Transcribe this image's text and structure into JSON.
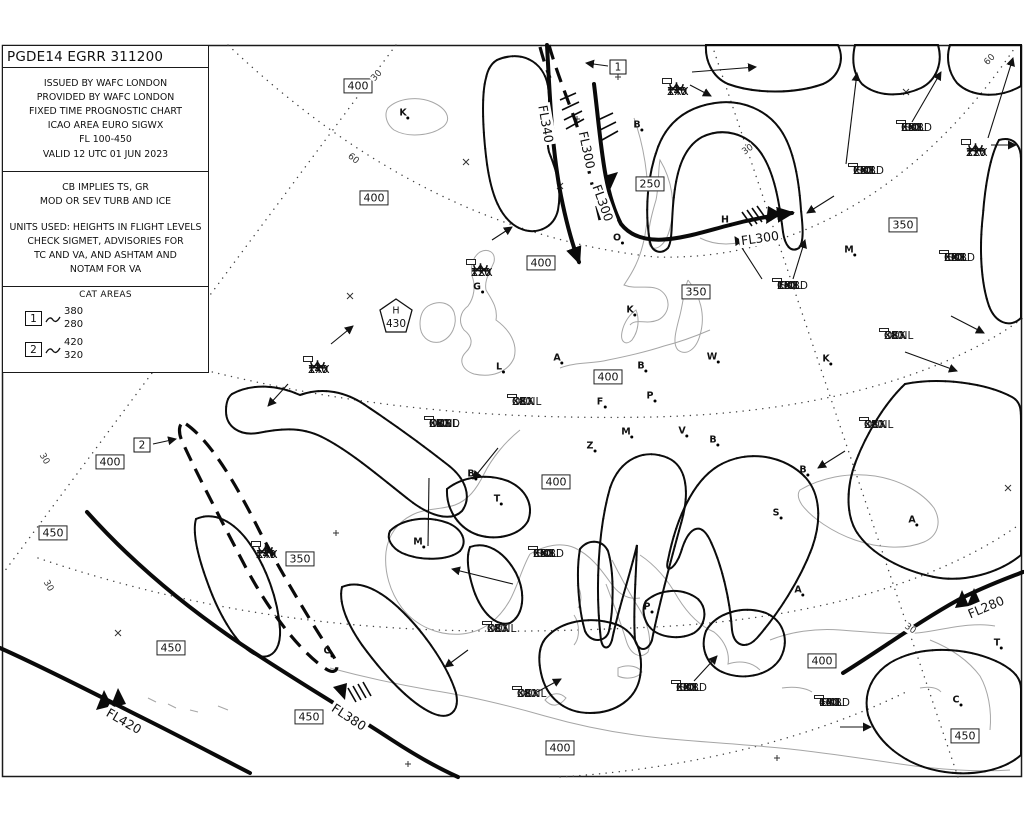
{
  "header": {
    "title": "PGDE14 EGRR 311200",
    "info_lines": [
      "ISSUED BY WAFC LONDON",
      "PROVIDED BY WAFC LONDON",
      "FIXED TIME PROGNOSTIC CHART",
      "ICAO AREA EURO SIGWX",
      "FL 100-450",
      "VALID 12 UTC 01 JUN 2023"
    ],
    "cb_note": [
      "CB IMPLIES TS, GR",
      "MOD OR SEV TURB AND ICE"
    ],
    "units_note": [
      "UNITS USED: HEIGHTS IN FLIGHT LEVELS",
      "CHECK SIGMET, ADVISORIES FOR",
      "TC AND VA, AND ASHTAM AND",
      "NOTAM FOR VA"
    ],
    "cat_areas": {
      "label": "CAT AREAS",
      "items": [
        {
          "id": "1",
          "top": "380",
          "base": "280"
        },
        {
          "id": "2",
          "top": "420",
          "base": "320"
        }
      ]
    }
  },
  "map": {
    "trop_high": {
      "label": "H",
      "value": "430"
    },
    "fl_boxes": [
      {
        "v": "400",
        "x": 358,
        "y": 86
      },
      {
        "v": "250",
        "x": 650,
        "y": 184
      },
      {
        "v": "400",
        "x": 374,
        "y": 198
      },
      {
        "v": "350",
        "x": 903,
        "y": 225
      },
      {
        "v": "400",
        "x": 541,
        "y": 263
      },
      {
        "v": "350",
        "x": 696,
        "y": 292
      },
      {
        "v": "400",
        "x": 608,
        "y": 377
      },
      {
        "v": "400",
        "x": 110,
        "y": 462
      },
      {
        "v": "450",
        "x": 53,
        "y": 533
      },
      {
        "v": "400",
        "x": 556,
        "y": 482
      },
      {
        "v": "350",
        "x": 300,
        "y": 559
      },
      {
        "v": "450",
        "x": 171,
        "y": 648
      },
      {
        "v": "400",
        "x": 822,
        "y": 661
      },
      {
        "v": "450",
        "x": 309,
        "y": 717
      },
      {
        "v": "400",
        "x": 560,
        "y": 748
      },
      {
        "v": "450",
        "x": 965,
        "y": 736
      }
    ],
    "cb_boxes": [
      {
        "lines": [
          "ISOL",
          "EMBD",
          "CB",
          "250",
          "XXX"
        ],
        "x": 853,
        "y": 163
      },
      {
        "lines": [
          "ISOL",
          "EMBD",
          "CB",
          "350",
          "XXX"
        ],
        "x": 901,
        "y": 120
      },
      {
        "lines": [
          "ISOL",
          "EMBD",
          "CB",
          "180",
          "XXX"
        ],
        "x": 777,
        "y": 278
      },
      {
        "lines": [
          "ISOL",
          "EMBD",
          "CB",
          "320",
          "XXX"
        ],
        "x": 944,
        "y": 250
      },
      {
        "lines": [
          "OCNL",
          "CB",
          "380",
          "XXX"
        ],
        "x": 884,
        "y": 328
      },
      {
        "lines": [
          "OCNL",
          "CB",
          "380",
          "XXX"
        ],
        "x": 864,
        "y": 417
      },
      {
        "lines": [
          "OCNL",
          "EMBD",
          "CB",
          "380",
          "XXX"
        ],
        "x": 429,
        "y": 416
      },
      {
        "lines": [
          "OCNL",
          "CB",
          "380",
          "XXX"
        ],
        "x": 512,
        "y": 394
      },
      {
        "lines": [
          "ISOL",
          "EMBD",
          "CB",
          "350",
          "XXX"
        ],
        "x": 533,
        "y": 546
      },
      {
        "lines": [
          "OCNL",
          "CB",
          "380",
          "XXX"
        ],
        "x": 487,
        "y": 621
      },
      {
        "lines": [
          "OCNL",
          "CB",
          "380",
          "XXX"
        ],
        "x": 517,
        "y": 686
      },
      {
        "lines": [
          "ISOL",
          "EMBD",
          "CB",
          "320",
          "XXX"
        ],
        "x": 676,
        "y": 680
      },
      {
        "lines": [
          "ISOL",
          "EMBD",
          "CB",
          "400",
          "140"
        ],
        "x": 819,
        "y": 695
      }
    ],
    "turb_ice_boxes": [
      {
        "turb": [
          "140",
          "XXX"
        ],
        "ice": [
          "140",
          "XXX"
        ],
        "x": 667,
        "y": 81
      },
      {
        "turb": [
          "120",
          "XXX"
        ],
        "ice": [
          "120",
          "XXX"
        ],
        "x": 471,
        "y": 262
      },
      {
        "turb": [
          "140",
          "XXX"
        ],
        "ice": [
          "140",
          "XXX"
        ],
        "x": 308,
        "y": 359
      },
      {
        "turb": [
          "220",
          "XXX"
        ],
        "ice": [
          "220",
          "110"
        ],
        "x": 966,
        "y": 142
      },
      {
        "turb": [
          "140",
          "XXX"
        ],
        "ice": [
          "140",
          "XXX"
        ],
        "x": 256,
        "y": 544
      }
    ],
    "cat_markers": [
      {
        "id": "1",
        "x": 618,
        "y": 67
      },
      {
        "id": "2",
        "x": 142,
        "y": 445
      }
    ],
    "jet_labels": [
      {
        "t": "FL340",
        "x": 546,
        "y": 124,
        "rot": 80
      },
      {
        "t": "FL300",
        "x": 587,
        "y": 150,
        "rot": 78
      },
      {
        "t": "FL300",
        "x": 603,
        "y": 203,
        "rot": 70
      },
      {
        "t": "FL300",
        "x": 760,
        "y": 238,
        "rot": -8
      },
      {
        "t": "FL420",
        "x": 124,
        "y": 721,
        "rot": 30
      },
      {
        "t": "FL380",
        "x": 349,
        "y": 717,
        "rot": 33
      },
      {
        "t": "FL280",
        "x": 986,
        "y": 607,
        "rot": -23
      }
    ],
    "grat_labels": [
      {
        "t": "60",
        "x": 353,
        "y": 159,
        "rot": 40
      },
      {
        "t": "60",
        "x": 990,
        "y": 60,
        "rot": -45
      },
      {
        "t": "30",
        "x": 377,
        "y": 76,
        "rot": -48
      },
      {
        "t": "30",
        "x": 44,
        "y": 459,
        "rot": 60
      },
      {
        "t": "30",
        "x": 48,
        "y": 586,
        "rot": 60
      },
      {
        "t": "30",
        "x": 748,
        "y": 150,
        "rot": -35
      },
      {
        "t": "30",
        "x": 910,
        "y": 629,
        "rot": 35
      }
    ],
    "cities": [
      {
        "l": "K",
        "x": 403,
        "y": 113
      },
      {
        "l": "B",
        "x": 637,
        "y": 125
      },
      {
        "l": "O",
        "x": 617,
        "y": 238
      },
      {
        "l": "G",
        "x": 477,
        "y": 287
      },
      {
        "l": "L",
        "x": 499,
        "y": 367
      },
      {
        "l": "A",
        "x": 557,
        "y": 358
      },
      {
        "l": "B",
        "x": 641,
        "y": 366
      },
      {
        "l": "W",
        "x": 712,
        "y": 357
      },
      {
        "l": "K",
        "x": 826,
        "y": 359
      },
      {
        "l": "M",
        "x": 849,
        "y": 250
      },
      {
        "l": "H",
        "x": 725,
        "y": 220
      },
      {
        "l": "K",
        "x": 630,
        "y": 310
      },
      {
        "l": "F",
        "x": 600,
        "y": 402
      },
      {
        "l": "P",
        "x": 650,
        "y": 396
      },
      {
        "l": "Z",
        "x": 590,
        "y": 446
      },
      {
        "l": "M",
        "x": 626,
        "y": 432
      },
      {
        "l": "V",
        "x": 682,
        "y": 431
      },
      {
        "l": "B",
        "x": 713,
        "y": 440
      },
      {
        "l": "B",
        "x": 803,
        "y": 470
      },
      {
        "l": "S",
        "x": 776,
        "y": 513
      },
      {
        "l": "T",
        "x": 497,
        "y": 499
      },
      {
        "l": "B",
        "x": 471,
        "y": 474
      },
      {
        "l": "M",
        "x": 418,
        "y": 542
      },
      {
        "l": "C",
        "x": 327,
        "y": 651
      },
      {
        "l": "A",
        "x": 798,
        "y": 590
      },
      {
        "l": "P",
        "x": 647,
        "y": 607
      },
      {
        "l": "A",
        "x": 912,
        "y": 520
      },
      {
        "l": "T",
        "x": 997,
        "y": 643
      },
      {
        "l": "C",
        "x": 956,
        "y": 700
      }
    ]
  }
}
